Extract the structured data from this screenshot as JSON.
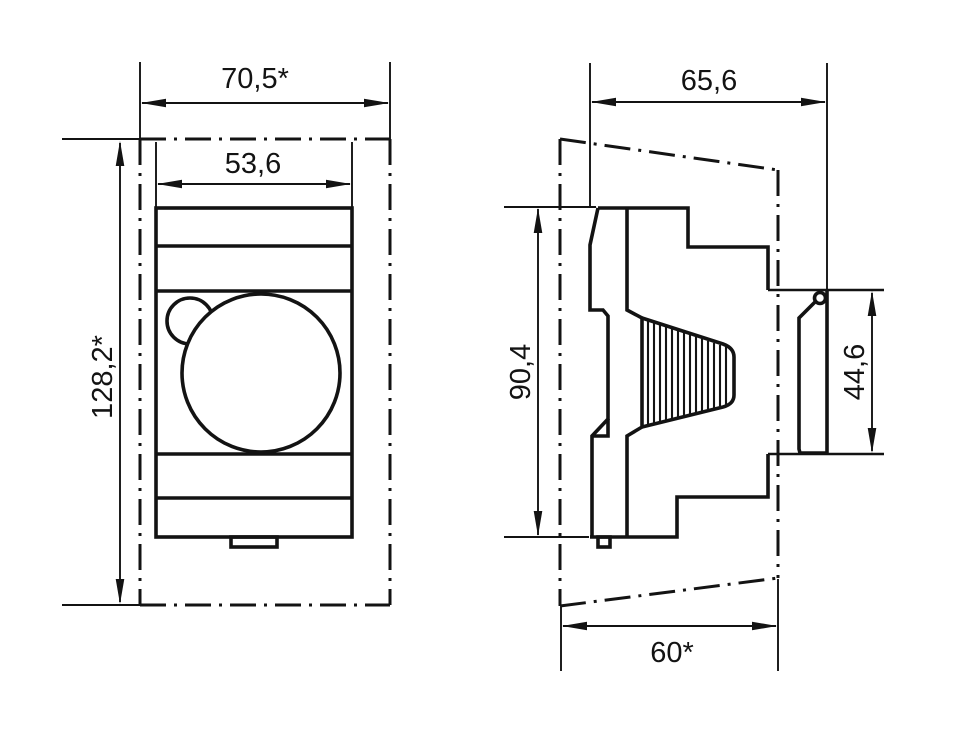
{
  "title": "DIN-rail device dimension drawing",
  "colors": {
    "line": "#131313",
    "background": "#ffffff"
  },
  "front_view": {
    "overall_width": "70,5*",
    "device_width": "53,6",
    "overall_height": "128,2*"
  },
  "side_view": {
    "overall_depth": "65,6",
    "device_height": "90,4",
    "clip_height": "44,6",
    "mounting_depth": "60*"
  }
}
